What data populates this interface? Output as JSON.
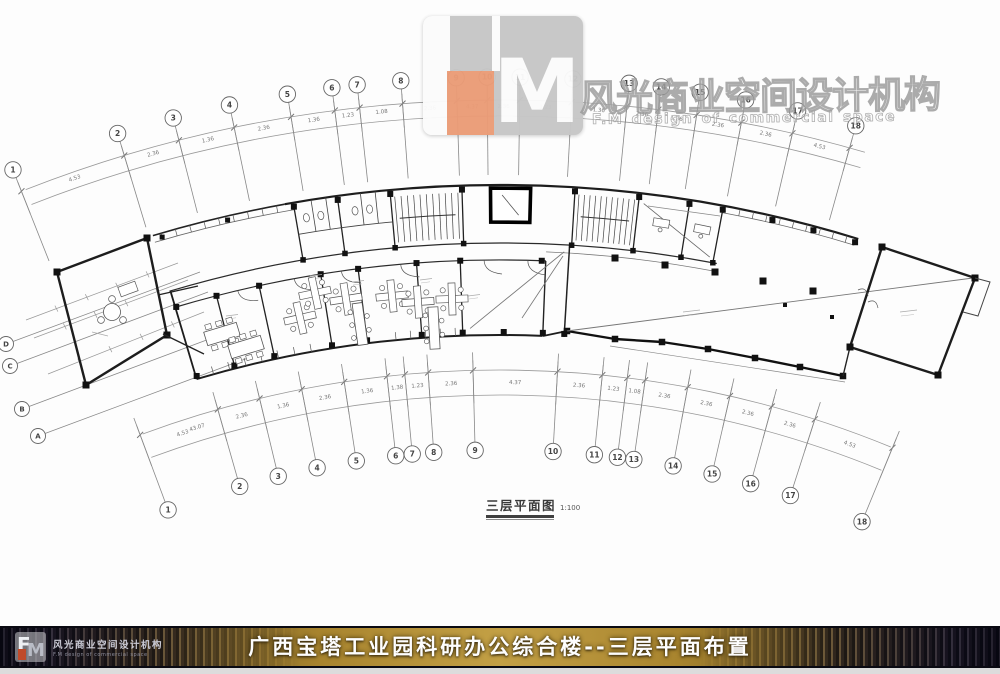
{
  "watermark": {
    "cn": "风光商业空间设计机构",
    "en": "F.M design of commercial space",
    "logo_m": "M"
  },
  "plan": {
    "caption": "三层平面图",
    "scale": "1:100",
    "axis_top_numbers": [
      "1",
      "2",
      "3",
      "4",
      "5",
      "6",
      "7",
      "8",
      "9",
      "10",
      "11",
      "12",
      "13",
      "14",
      "15",
      "16",
      "17",
      "18"
    ],
    "axis_bottom_numbers": [
      "1",
      "2",
      "3",
      "4",
      "5",
      "6",
      "7",
      "8",
      "9",
      "10",
      "11",
      "12",
      "13",
      "14",
      "15",
      "16",
      "17",
      "18"
    ],
    "axis_left_letters": [
      "D",
      "C",
      "B",
      "A"
    ],
    "dims_top": [
      "4.53",
      "2.36",
      "1.36",
      "2.36",
      "1.36",
      "1.23",
      "1.08",
      "2.36",
      "4.37",
      "2.36",
      "1.23",
      "1.36",
      "2.36",
      "1.36",
      "2.36",
      "2.36",
      "4.53"
    ],
    "dims_bottom": [
      "4.53",
      "2.36",
      "1.36",
      "2.36",
      "1.36",
      "1.38",
      "1.23",
      "2.36",
      "4.37",
      "2.36",
      "1.23",
      "1.08",
      "2.36",
      "2.36",
      "2.36",
      "2.36",
      "4.53"
    ],
    "dim_total": "43.07"
  },
  "footer": {
    "title": "广西宝塔工业园科研办公综合楼--三层平面布置",
    "fm_f": "F",
    "fm_m": "M",
    "brand_cn": "风光商业空间设计机构",
    "brand_en": "F.M design of commercial space",
    "gold": "#b8923a"
  },
  "colors": {
    "logo_orange": "#eb9c77",
    "wall": "#1f1f1f",
    "grid": "#9a9a9a"
  }
}
